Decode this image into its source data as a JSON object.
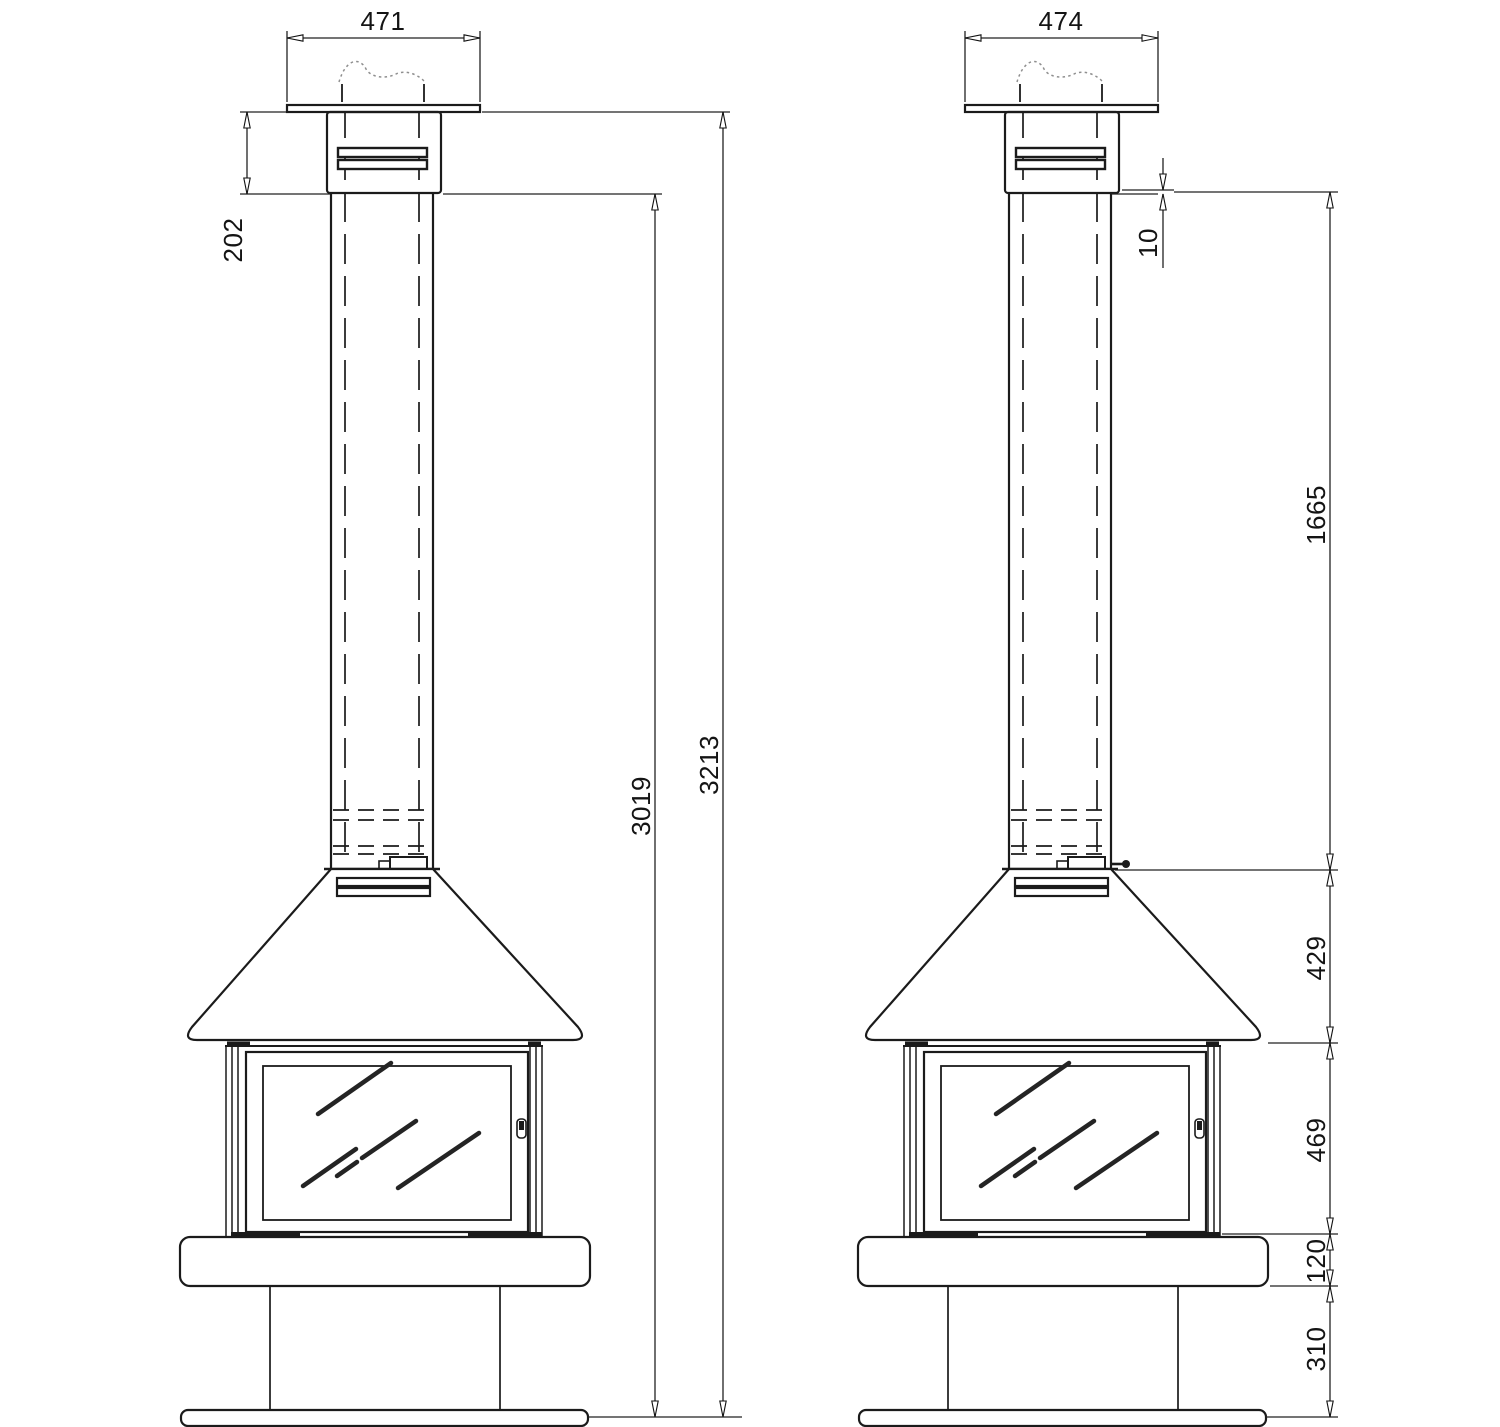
{
  "drawing": {
    "kind": "fireplace-technical-drawing",
    "colors": {
      "ink": "#1b1b1b",
      "background": "#ffffff"
    },
    "front_view": {
      "cap_width": "471",
      "cap_height": "202",
      "body_height": "3019",
      "overall_height": "3213"
    },
    "side_view": {
      "cap_width": "474",
      "pipe_inset": "10",
      "pipe_length": "1665",
      "hood_height": "429",
      "firebox_height": "469",
      "plinth_height": "120",
      "pedestal_height": "310"
    }
  }
}
